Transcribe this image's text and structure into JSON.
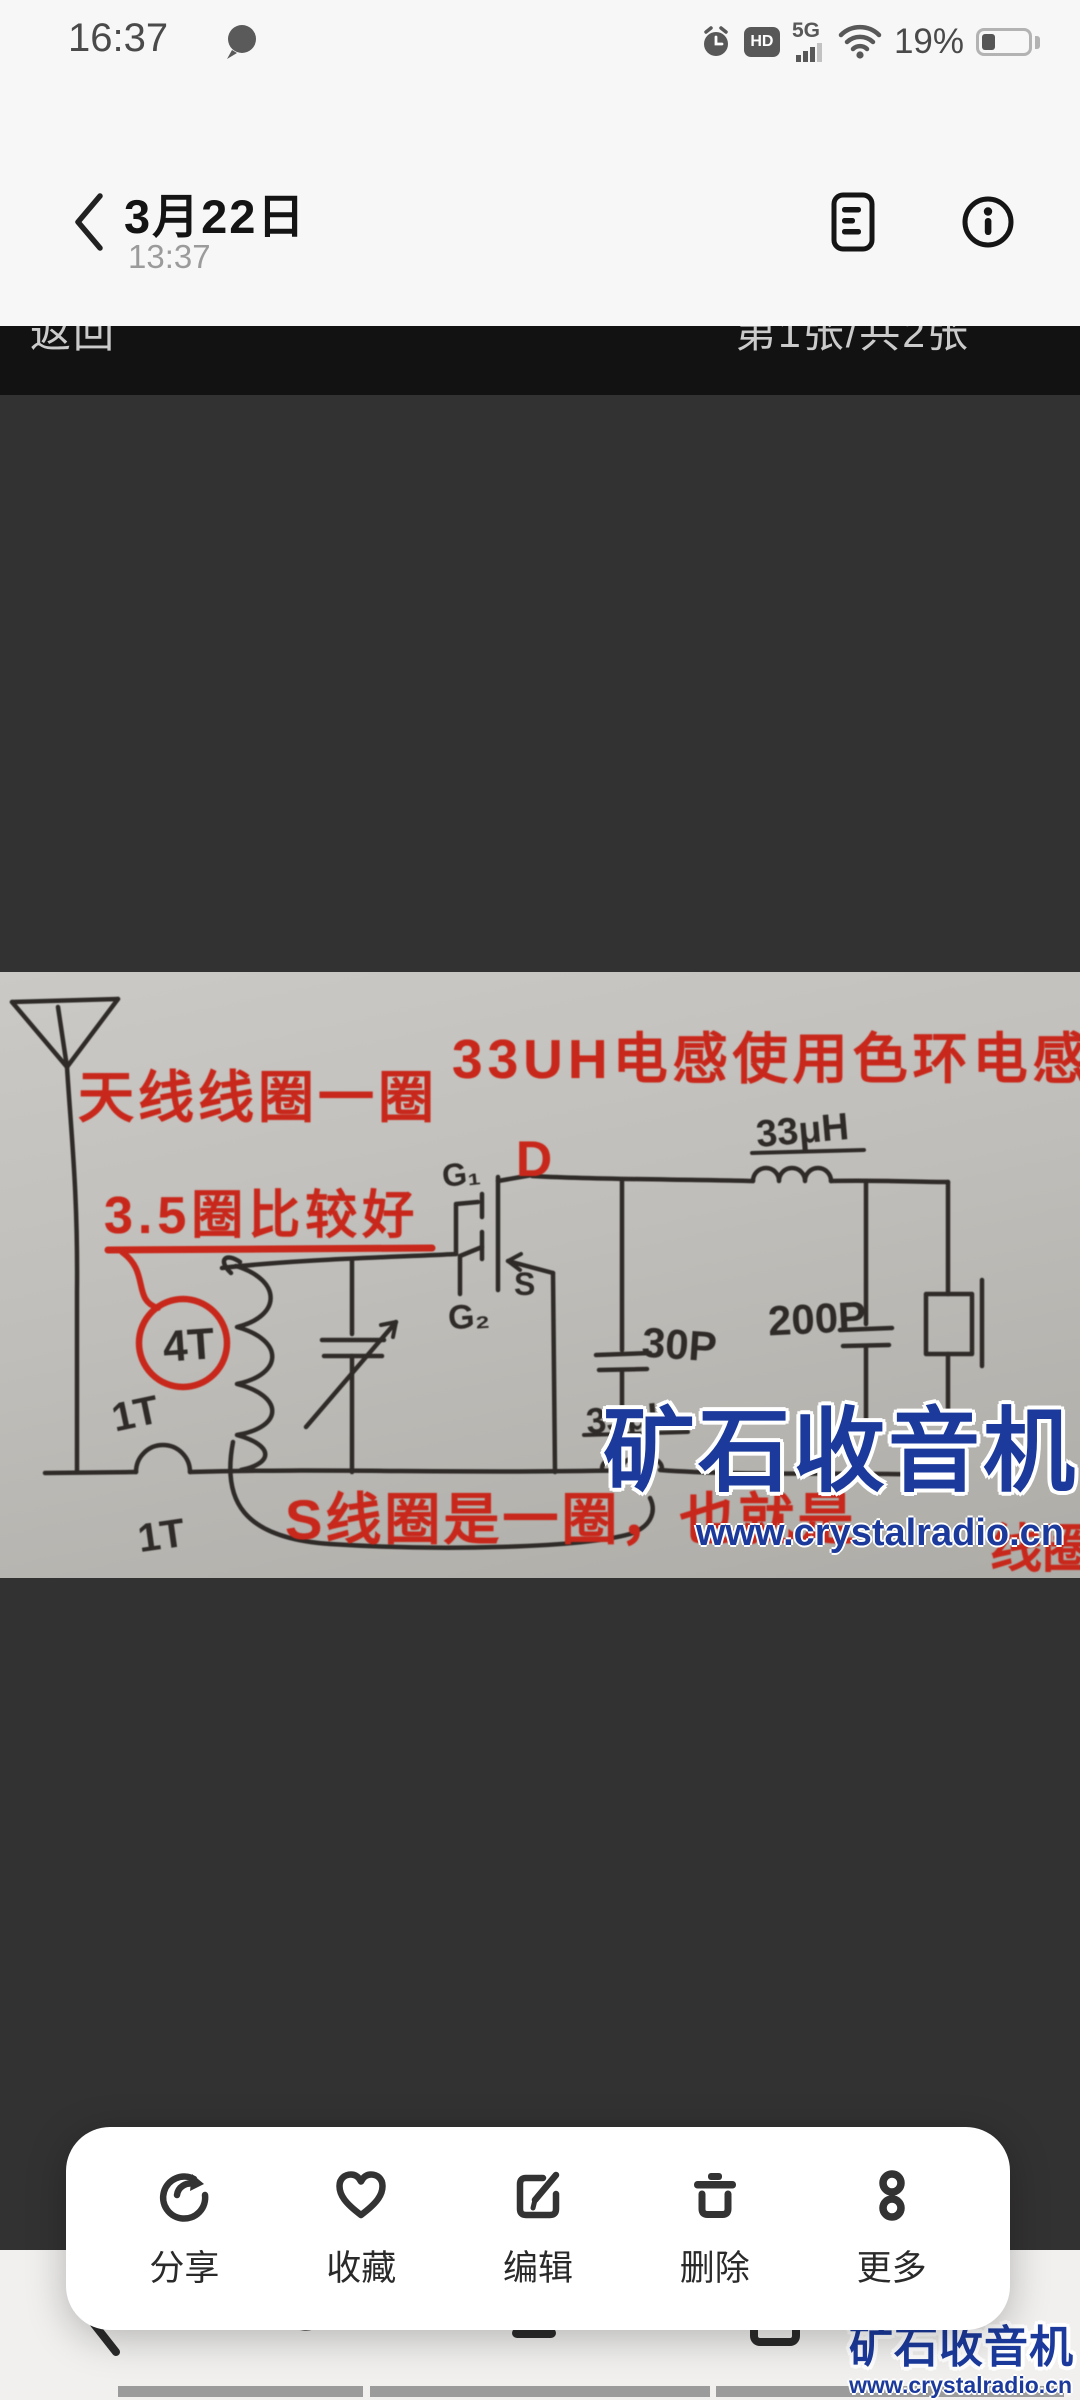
{
  "colors": {
    "accent_red": "#c8281b",
    "ink": "#2e2b28",
    "watermark_blue": "#1b3a9c",
    "paper": "#c0beba",
    "overlay_dark": "#333232",
    "overlay_black": "#121212",
    "header_bg": "#f7f7f7",
    "card_bg": "#ffffff"
  },
  "status_bar": {
    "time": "16:37",
    "network": "5G",
    "hd_badge": "HD",
    "battery": "19%"
  },
  "header": {
    "title": "3月22日",
    "subtitle": "13:37"
  },
  "viewer_bar": {
    "back_label": "返回",
    "counter_label": "第1张/共2张"
  },
  "photo": {
    "note_antenna": "天线线圈一圈",
    "note_inductor": "33UH电感使用色环电感",
    "note_turns": "3.5圈比较好",
    "note_s_coil": "S线圈是一圈，也就是",
    "note_s_coil_tail": "线圈",
    "label_d": "D",
    "label_g1": "G₁",
    "label_g2": "G₂",
    "label_s": "S",
    "label_4t": "4T",
    "label_1t_upper": "1T",
    "label_1t_lower": "1T",
    "label_l1": "33μH",
    "label_l2": "33μH",
    "label_c1": "30P",
    "label_c2": "200P",
    "watermark_title": "矿石收音机",
    "watermark_url": "www.crystalradio.cn"
  },
  "action_bar": {
    "items": [
      {
        "id": "share",
        "label": "分享"
      },
      {
        "id": "favorite",
        "label": "收藏"
      },
      {
        "id": "edit",
        "label": "编辑"
      },
      {
        "id": "delete",
        "label": "删除"
      },
      {
        "id": "more",
        "label": "更多"
      }
    ]
  },
  "page_watermark": {
    "title": "矿石收音机",
    "url": "www.crystalradio.cn"
  }
}
